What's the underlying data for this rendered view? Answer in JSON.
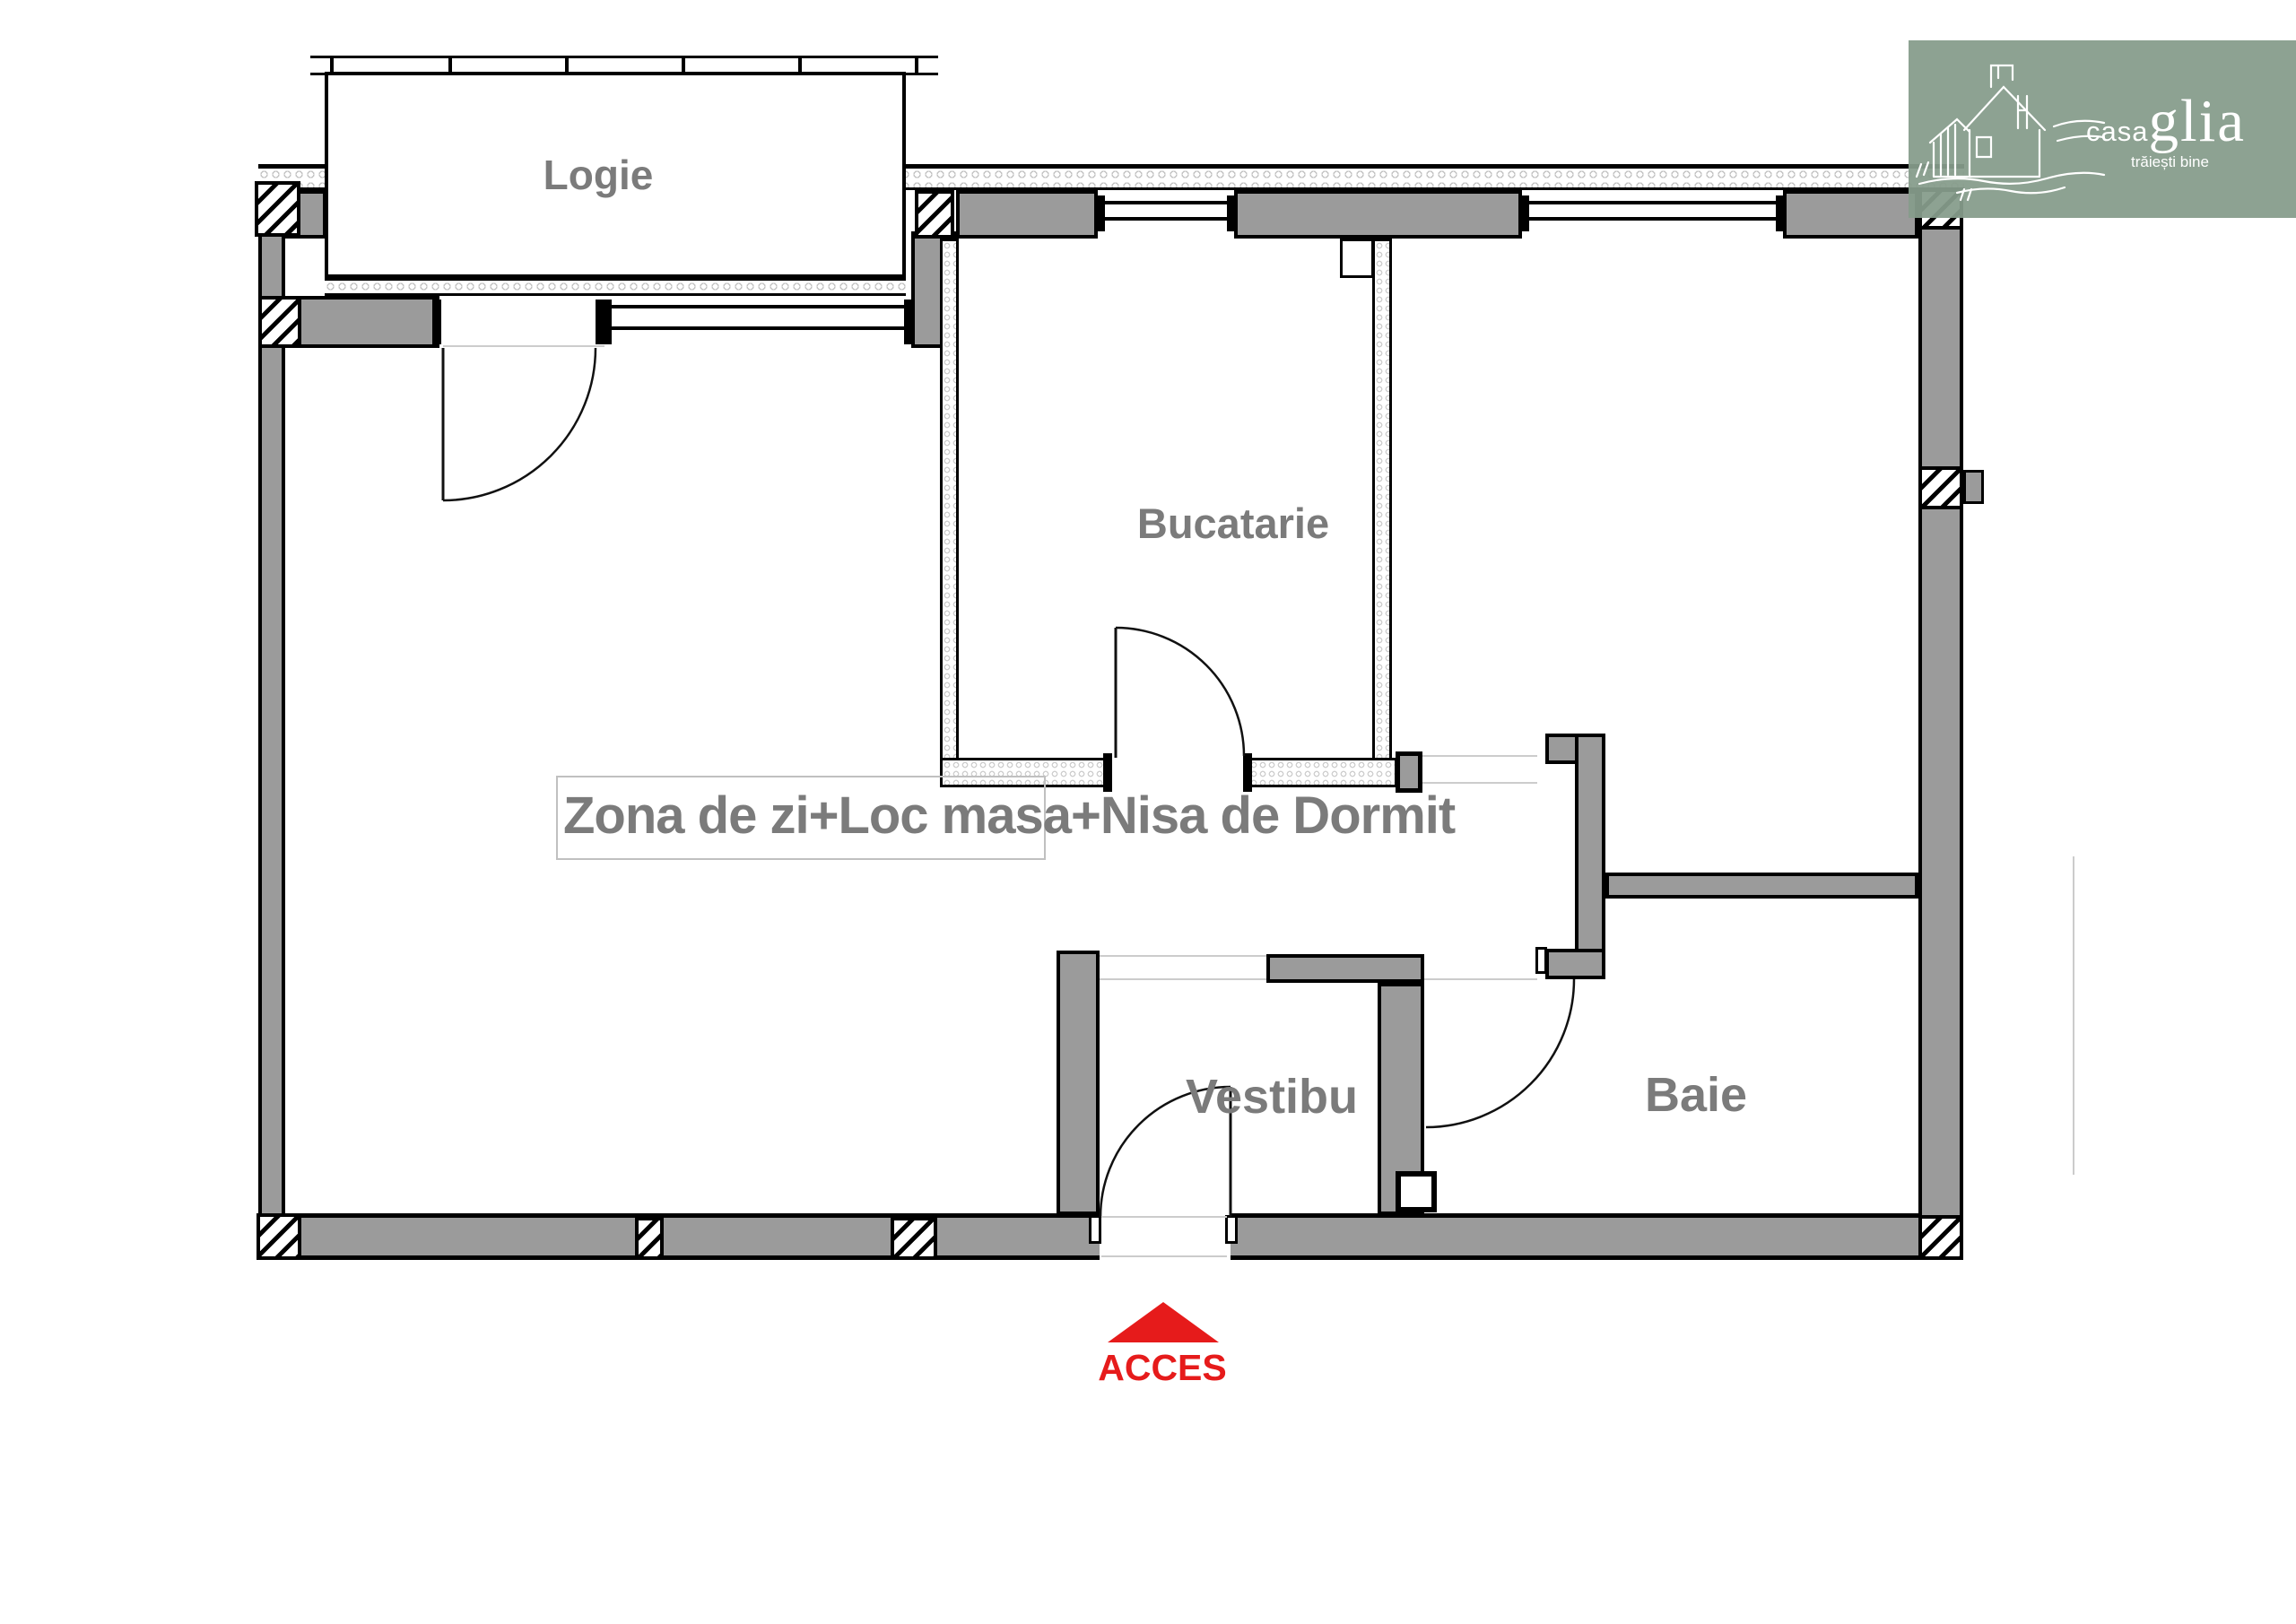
{
  "plan": {
    "rooms": {
      "logie": {
        "label": "Logie"
      },
      "bucatarie": {
        "label": "Bucatarie"
      },
      "living": {
        "label": "Zona de zi+Loc masa+Nisa de Dormit"
      },
      "vestibul": {
        "label": "Vestibu"
      },
      "baie": {
        "label": "Baie"
      }
    },
    "access": {
      "label": "ACCES",
      "color": "#E61B1B",
      "icon": "access-arrow-icon"
    },
    "colors": {
      "wall_fill": "#9B9B9B",
      "wall_outline": "#000000",
      "room_label": "#7B7B7B",
      "insulation_dot": "#C4C4C4",
      "partition_dot": "#CFCFCF",
      "faint_line": "#CCCCCC",
      "label_frame": "#C0C0C0"
    }
  },
  "logo": {
    "brand_small": "casa",
    "brand_large": "glia",
    "tagline": "trăiești bine",
    "background": "#869C8B",
    "icon": "house-sketch-icon"
  }
}
